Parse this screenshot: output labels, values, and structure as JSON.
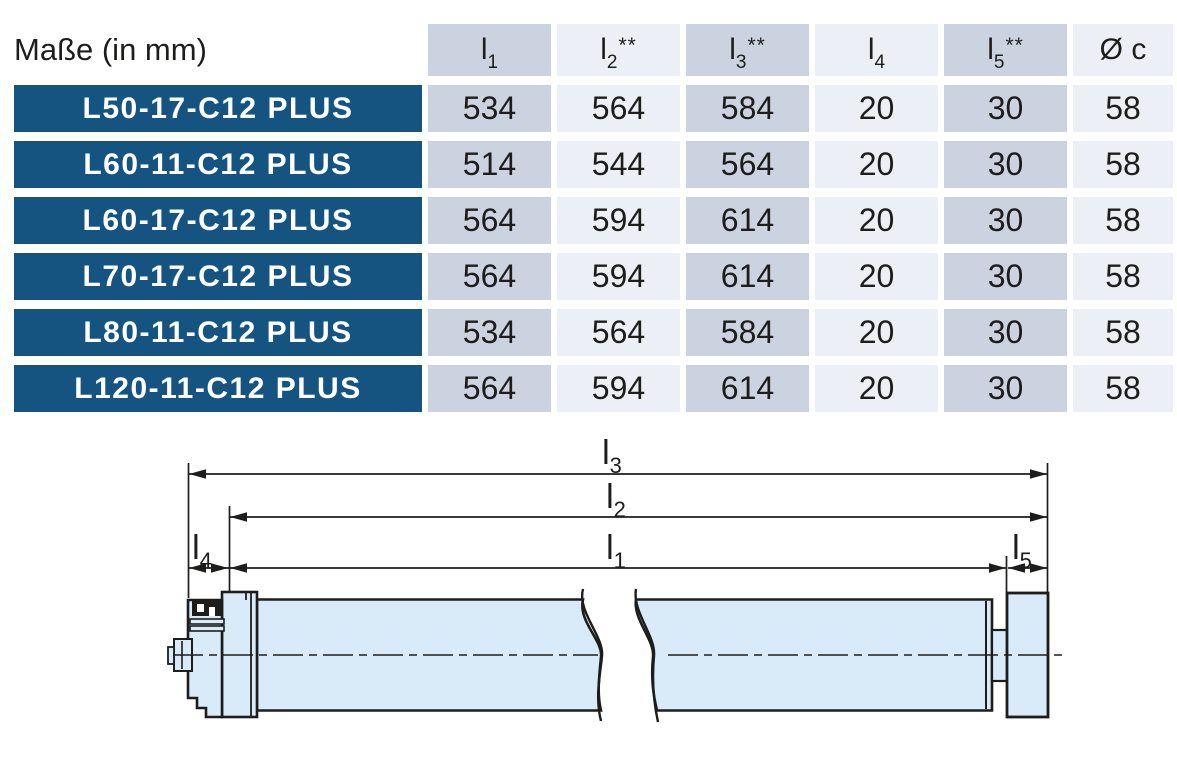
{
  "table": {
    "title": "Maße (in mm)",
    "columns": [
      {
        "base": "l",
        "sub": "1",
        "sup": ""
      },
      {
        "base": "l",
        "sub": "2",
        "sup": "**"
      },
      {
        "base": "l",
        "sub": "3",
        "sup": "**"
      },
      {
        "base": "l",
        "sub": "4",
        "sup": ""
      },
      {
        "base": "l",
        "sub": "5",
        "sup": "**"
      },
      {
        "base": "Ø c",
        "sub": "",
        "sup": ""
      }
    ],
    "rows": [
      {
        "model": "L50-17-C12 PLUS",
        "values": [
          "534",
          "564",
          "584",
          "20",
          "30",
          "58"
        ]
      },
      {
        "model": "L60-11-C12 PLUS",
        "values": [
          "514",
          "544",
          "564",
          "20",
          "30",
          "58"
        ]
      },
      {
        "model": "L60-17-C12 PLUS",
        "values": [
          "564",
          "594",
          "614",
          "20",
          "30",
          "58"
        ]
      },
      {
        "model": "L70-17-C12 PLUS",
        "values": [
          "564",
          "594",
          "614",
          "20",
          "30",
          "58"
        ]
      },
      {
        "model": "L80-11-C12 PLUS",
        "values": [
          "534",
          "564",
          "584",
          "20",
          "30",
          "58"
        ]
      },
      {
        "model": "L120-11-C12 PLUS",
        "values": [
          "564",
          "594",
          "614",
          "20",
          "30",
          "58"
        ]
      }
    ]
  },
  "diagram": {
    "labels": {
      "l1": {
        "base": "l",
        "sub": "1"
      },
      "l2": {
        "base": "l",
        "sub": "2"
      },
      "l3": {
        "base": "l",
        "sub": "3"
      },
      "l4": {
        "base": "l",
        "sub": "4"
      },
      "l5": {
        "base": "l",
        "sub": "5"
      },
      "diameter": "Ø c"
    }
  },
  "colors": {
    "brand_blue": "#155480",
    "column_shade_dark": "#cbd2e0",
    "column_shade_light": "#eceff6",
    "tube_fill": "#d9eaf8",
    "line_color": "#1d1d1b",
    "row_label_text": "#ffffff"
  }
}
